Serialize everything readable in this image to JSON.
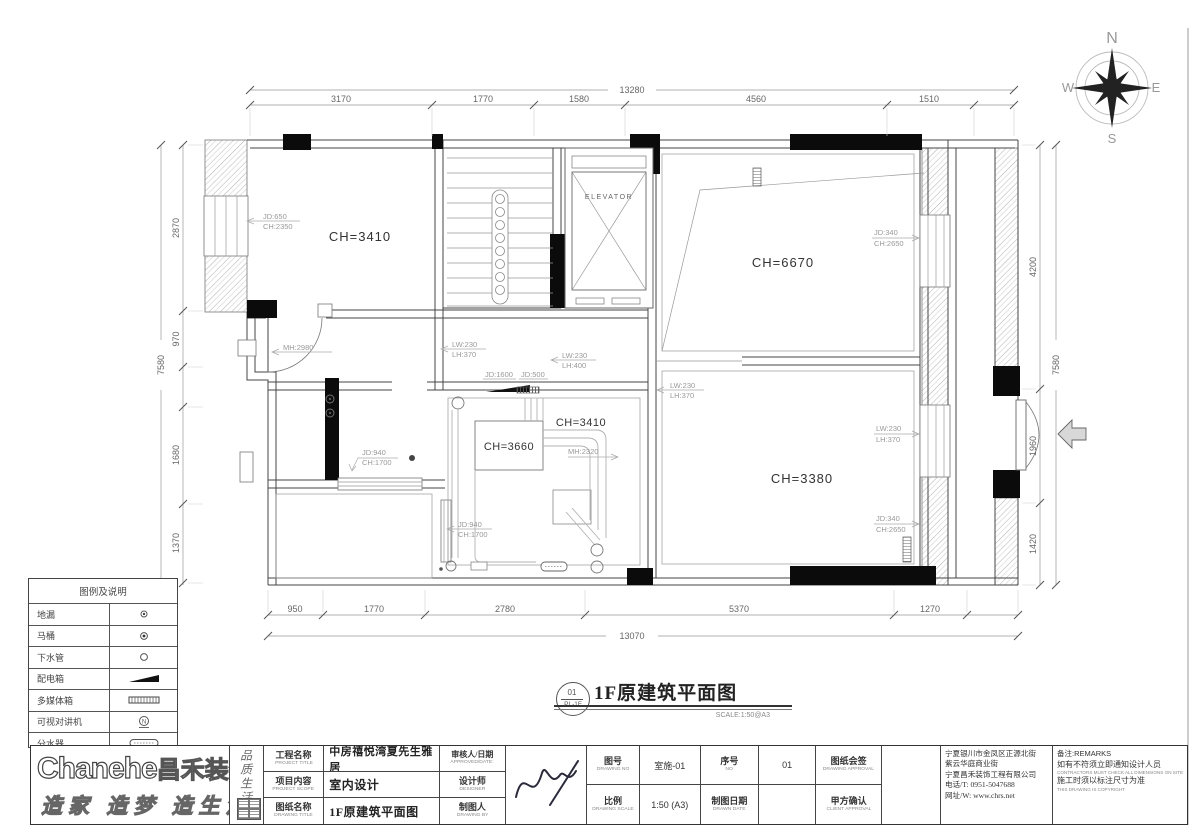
{
  "compass": {
    "n": "N",
    "s": "S",
    "e": "E",
    "w": "W"
  },
  "plan": {
    "rooms": {
      "top_left": "CH=3410",
      "right_top": "CH=6670",
      "right_bottom": "CH=3380",
      "pipe_box": "CH=3660",
      "mid": "CH=3410",
      "elevator": "ELEVATOR"
    },
    "ann": {
      "win_left": [
        "JD:650",
        "CH:2350"
      ],
      "hall_door": "MH:2980",
      "beam1": [
        "LW:230",
        "LH:370"
      ],
      "beam2": [
        "LW:230",
        "LH:400"
      ],
      "jd1600": "JD:1600",
      "jd500": "JD:500",
      "beam3": [
        "LW:230",
        "LH:370"
      ],
      "mid_mh": "MH:2320",
      "toilet_win": [
        "JD:940",
        "CH:1700"
      ],
      "bath_win": [
        "JD:940",
        "CH:1700"
      ],
      "win_rt": [
        "JD:340",
        "CH:2650"
      ],
      "beam4": [
        "LW:230",
        "LH:370"
      ],
      "win_rb": [
        "JD:340",
        "CH:2650"
      ]
    },
    "dims": {
      "top": {
        "total": "13280",
        "segments": [
          "3170",
          "1770",
          "1580",
          "4560",
          "1510"
        ]
      },
      "bottom": {
        "total": "13070",
        "segments": [
          "950",
          "1770",
          "2780",
          "5370",
          "1270"
        ]
      },
      "left": {
        "total": "7580",
        "segments": [
          "2870",
          "970",
          "1680",
          "1370"
        ]
      },
      "right": {
        "total": "7580",
        "segments": [
          "4200",
          "1960",
          "1420"
        ]
      }
    }
  },
  "legend": {
    "title": "图例及说明",
    "rows": [
      {
        "label": "地漏",
        "symbol": "floor-drain"
      },
      {
        "label": "马桶",
        "symbol": "toilet"
      },
      {
        "label": "下水管",
        "symbol": "drain-pipe"
      },
      {
        "label": "配电箱",
        "symbol": "power-box"
      },
      {
        "label": "多媒体箱",
        "symbol": "media-box"
      },
      {
        "label": "可视对讲机",
        "symbol": "video-intercom"
      },
      {
        "label": "分水器",
        "symbol": "water-manifold"
      }
    ]
  },
  "sheet_title": {
    "badge_top": "01",
    "badge_bottom": "PL-1F",
    "text": "1F原建筑平面图",
    "scale": "SCALE:1:50@A3"
  },
  "title_block": {
    "logo": {
      "brand_en": "Chanehe",
      "brand_cn": "昌禾装饰",
      "slogan": "造家 造梦 造生活",
      "side_text": "品质生活"
    },
    "fields": {
      "project_label": "工程名称",
      "project_label_en": "PROJECT TITLE",
      "project_value": "中房禧悦湾夏先生雅居",
      "scope_label": "项目内容",
      "scope_label_en": "PROJECT SCOPE",
      "scope_value": "室内设计",
      "dtitle_label": "图纸名称",
      "dtitle_label_en": "DRAWING TITLE",
      "dtitle_value": "1F原建筑平面图",
      "approved_label": "审核人/日期",
      "approved_label_en": "APPROVED/DATE:",
      "designer_label": "设计师",
      "designer_label_en": "DESIGNER",
      "drafter_label": "制图人",
      "drafter_label_en": "DRAWING BY",
      "dno_label": "图号",
      "dno_label_en": "DRAWING NO",
      "dno_value": "室施-01",
      "seq_label": "序号",
      "seq_label_en": "NO",
      "seq_value": "01",
      "approval_label": "图纸会签",
      "approval_label_en": "DRAWING APPROVAL",
      "scale_label": "比例",
      "scale_label_en": "DRAWING SCALE",
      "scale_value": "1:50 (A3)",
      "date_label": "制图日期",
      "date_label_en": "DRAWN DATE",
      "client_label": "甲方确认",
      "client_label_en": "CLIENT APPROVAL"
    },
    "company": {
      "address1": "宁夏银川市金凤区正源北街",
      "address2": "紫云华庭商业街",
      "name": "宁夏昌禾装饰工程有限公司",
      "phone": "电话/T: 0951-5047688",
      "web": "网址/W: www.chrs.net"
    },
    "remarks": {
      "title": "备注:REMARKS",
      "line1": "如有不符须立即通知设计人员",
      "line1_en": "CONTRACTORS MUST CHECK ALL DIMENSIONS ON SITE",
      "line2": "施工时须以标注尺寸为准",
      "line2_en": "THIS DRAWING IS COPYRIGHT"
    }
  }
}
